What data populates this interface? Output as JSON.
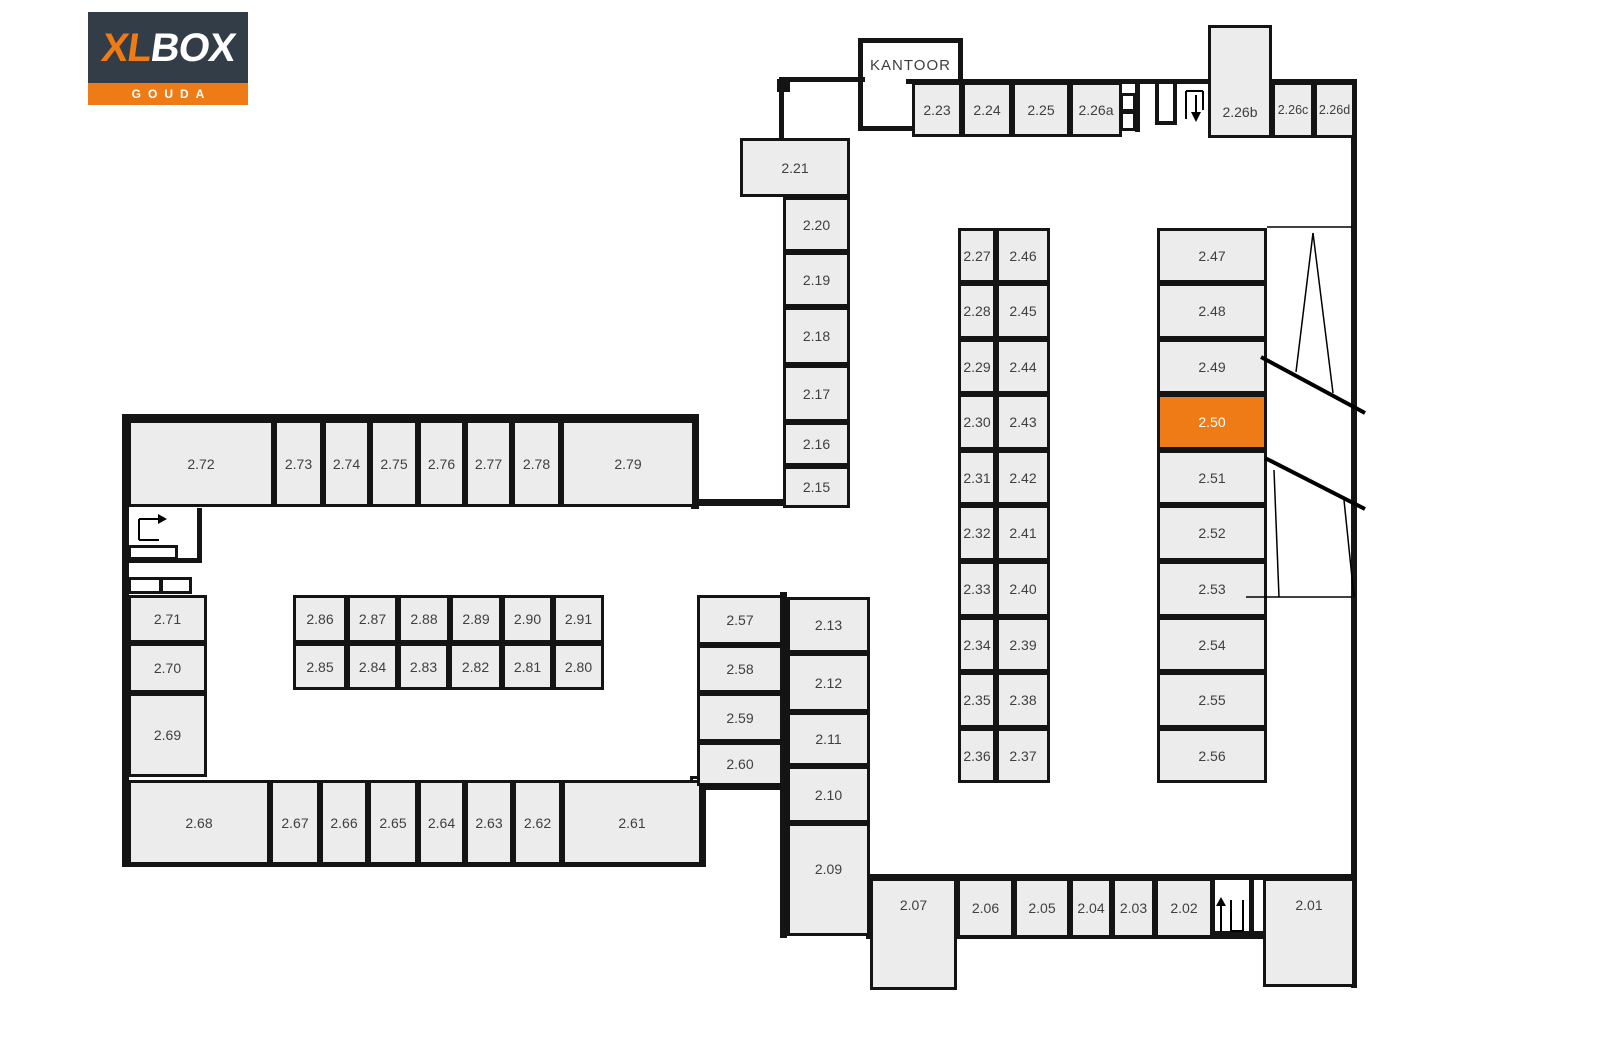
{
  "logo": {
    "brand_xl": "XL",
    "brand_box": "BOX",
    "city": "GOUDA"
  },
  "colors": {
    "navy": "#333D47",
    "orange": "#EE7B16",
    "unit_fill": "#ECECEC",
    "wall": "#141414",
    "label": "#3f3f3f",
    "highlight_label": "#ffffff"
  },
  "office": {
    "label": "KANTOOR",
    "x": 858,
    "y": 38,
    "w": 105,
    "h": 93
  },
  "highlighted_unit": "2.50",
  "units": [
    {
      "id": "2.23",
      "x": 912,
      "y": 82,
      "w": 50,
      "h": 55
    },
    {
      "id": "2.24",
      "x": 962,
      "y": 82,
      "w": 50,
      "h": 55
    },
    {
      "id": "2.25",
      "x": 1012,
      "y": 82,
      "w": 58,
      "h": 55
    },
    {
      "id": "2.26a",
      "x": 1070,
      "y": 82,
      "w": 52,
      "h": 55
    },
    {
      "id": "2.26b",
      "x": 1208,
      "y": 25,
      "w": 64,
      "h": 113,
      "ly": 110
    },
    {
      "id": "2.26c",
      "x": 1272,
      "y": 82,
      "w": 42,
      "h": 56,
      "fs": 12.5
    },
    {
      "id": "2.26d",
      "x": 1314,
      "y": 82,
      "w": 41,
      "h": 56,
      "fs": 12.5
    },
    {
      "id": "2.21",
      "x": 740,
      "y": 138,
      "w": 110,
      "h": 59
    },
    {
      "id": "2.20",
      "x": 783,
      "y": 197,
      "w": 67,
      "h": 55
    },
    {
      "id": "2.19",
      "x": 783,
      "y": 252,
      "w": 67,
      "h": 55
    },
    {
      "id": "2.18",
      "x": 783,
      "y": 307,
      "w": 67,
      "h": 58
    },
    {
      "id": "2.17",
      "x": 783,
      "y": 365,
      "w": 67,
      "h": 57
    },
    {
      "id": "2.16",
      "x": 783,
      "y": 422,
      "w": 67,
      "h": 44
    },
    {
      "id": "2.15",
      "x": 783,
      "y": 466,
      "w": 67,
      "h": 42
    },
    {
      "id": "2.27",
      "x": 958,
      "y": 228,
      "w": 38,
      "h": 55
    },
    {
      "id": "2.28",
      "x": 958,
      "y": 283,
      "w": 38,
      "h": 56
    },
    {
      "id": "2.29",
      "x": 958,
      "y": 339,
      "w": 38,
      "h": 55
    },
    {
      "id": "2.30",
      "x": 958,
      "y": 394,
      "w": 38,
      "h": 56
    },
    {
      "id": "2.31",
      "x": 958,
      "y": 450,
      "w": 38,
      "h": 55
    },
    {
      "id": "2.32",
      "x": 958,
      "y": 505,
      "w": 38,
      "h": 56
    },
    {
      "id": "2.33",
      "x": 958,
      "y": 561,
      "w": 38,
      "h": 56
    },
    {
      "id": "2.34",
      "x": 958,
      "y": 617,
      "w": 38,
      "h": 55
    },
    {
      "id": "2.35",
      "x": 958,
      "y": 672,
      "w": 38,
      "h": 56
    },
    {
      "id": "2.36",
      "x": 958,
      "y": 728,
      "w": 38,
      "h": 55
    },
    {
      "id": "2.46",
      "x": 996,
      "y": 228,
      "w": 54,
      "h": 55
    },
    {
      "id": "2.45",
      "x": 996,
      "y": 283,
      "w": 54,
      "h": 56
    },
    {
      "id": "2.44",
      "x": 996,
      "y": 339,
      "w": 54,
      "h": 55
    },
    {
      "id": "2.43",
      "x": 996,
      "y": 394,
      "w": 54,
      "h": 56
    },
    {
      "id": "2.42",
      "x": 996,
      "y": 450,
      "w": 54,
      "h": 55
    },
    {
      "id": "2.41",
      "x": 996,
      "y": 505,
      "w": 54,
      "h": 56
    },
    {
      "id": "2.40",
      "x": 996,
      "y": 561,
      "w": 54,
      "h": 56
    },
    {
      "id": "2.39",
      "x": 996,
      "y": 617,
      "w": 54,
      "h": 55
    },
    {
      "id": "2.38",
      "x": 996,
      "y": 672,
      "w": 54,
      "h": 56
    },
    {
      "id": "2.37",
      "x": 996,
      "y": 728,
      "w": 54,
      "h": 55
    },
    {
      "id": "2.47",
      "x": 1157,
      "y": 228,
      "w": 110,
      "h": 55
    },
    {
      "id": "2.48",
      "x": 1157,
      "y": 283,
      "w": 110,
      "h": 56
    },
    {
      "id": "2.49",
      "x": 1157,
      "y": 339,
      "w": 110,
      "h": 55
    },
    {
      "id": "2.50",
      "x": 1157,
      "y": 394,
      "w": 110,
      "h": 56,
      "hl": true
    },
    {
      "id": "2.51",
      "x": 1157,
      "y": 450,
      "w": 110,
      "h": 55
    },
    {
      "id": "2.52",
      "x": 1157,
      "y": 505,
      "w": 110,
      "h": 56
    },
    {
      "id": "2.53",
      "x": 1157,
      "y": 561,
      "w": 110,
      "h": 56
    },
    {
      "id": "2.54",
      "x": 1157,
      "y": 617,
      "w": 110,
      "h": 55
    },
    {
      "id": "2.55",
      "x": 1157,
      "y": 672,
      "w": 110,
      "h": 56
    },
    {
      "id": "2.56",
      "x": 1157,
      "y": 728,
      "w": 110,
      "h": 55
    },
    {
      "id": "2.72",
      "x": 128,
      "y": 420,
      "w": 146,
      "h": 87
    },
    {
      "id": "2.73",
      "x": 274,
      "y": 420,
      "w": 49,
      "h": 87
    },
    {
      "id": "2.74",
      "x": 323,
      "y": 420,
      "w": 47,
      "h": 87
    },
    {
      "id": "2.75",
      "x": 370,
      "y": 420,
      "w": 48,
      "h": 87
    },
    {
      "id": "2.76",
      "x": 418,
      "y": 420,
      "w": 47,
      "h": 87
    },
    {
      "id": "2.77",
      "x": 465,
      "y": 420,
      "w": 47,
      "h": 87
    },
    {
      "id": "2.78",
      "x": 512,
      "y": 420,
      "w": 49,
      "h": 87
    },
    {
      "id": "2.79",
      "x": 561,
      "y": 420,
      "w": 134,
      "h": 87
    },
    {
      "id": "2.71",
      "x": 128,
      "y": 595,
      "w": 79,
      "h": 48
    },
    {
      "id": "2.70",
      "x": 128,
      "y": 643,
      "w": 79,
      "h": 50
    },
    {
      "id": "2.69",
      "x": 128,
      "y": 693,
      "w": 79,
      "h": 84
    },
    {
      "id": "2.86",
      "x": 293,
      "y": 595,
      "w": 54,
      "h": 48
    },
    {
      "id": "2.87",
      "x": 347,
      "y": 595,
      "w": 51,
      "h": 48
    },
    {
      "id": "2.88",
      "x": 398,
      "y": 595,
      "w": 52,
      "h": 48
    },
    {
      "id": "2.89",
      "x": 450,
      "y": 595,
      "w": 52,
      "h": 48
    },
    {
      "id": "2.90",
      "x": 502,
      "y": 595,
      "w": 51,
      "h": 48
    },
    {
      "id": "2.91",
      "x": 553,
      "y": 595,
      "w": 51,
      "h": 48
    },
    {
      "id": "2.85",
      "x": 293,
      "y": 643,
      "w": 54,
      "h": 47
    },
    {
      "id": "2.84",
      "x": 347,
      "y": 643,
      "w": 51,
      "h": 47
    },
    {
      "id": "2.83",
      "x": 398,
      "y": 643,
      "w": 51,
      "h": 47
    },
    {
      "id": "2.82",
      "x": 449,
      "y": 643,
      "w": 53,
      "h": 47
    },
    {
      "id": "2.81",
      "x": 502,
      "y": 643,
      "w": 51,
      "h": 47
    },
    {
      "id": "2.80",
      "x": 553,
      "y": 643,
      "w": 51,
      "h": 47
    },
    {
      "id": "2.68",
      "x": 128,
      "y": 780,
      "w": 142,
      "h": 85
    },
    {
      "id": "2.67",
      "x": 270,
      "y": 780,
      "w": 50,
      "h": 85
    },
    {
      "id": "2.66",
      "x": 320,
      "y": 780,
      "w": 48,
      "h": 85
    },
    {
      "id": "2.65",
      "x": 368,
      "y": 780,
      "w": 50,
      "h": 85
    },
    {
      "id": "2.64",
      "x": 418,
      "y": 780,
      "w": 47,
      "h": 85
    },
    {
      "id": "2.63",
      "x": 465,
      "y": 780,
      "w": 48,
      "h": 85
    },
    {
      "id": "2.62",
      "x": 513,
      "y": 780,
      "w": 49,
      "h": 85
    },
    {
      "id": "2.61",
      "x": 562,
      "y": 780,
      "w": 140,
      "h": 85
    },
    {
      "id": "2.57",
      "x": 697,
      "y": 595,
      "w": 86,
      "h": 50
    },
    {
      "id": "2.58",
      "x": 697,
      "y": 645,
      "w": 86,
      "h": 48
    },
    {
      "id": "2.59",
      "x": 697,
      "y": 693,
      "w": 86,
      "h": 49
    },
    {
      "id": "2.60",
      "x": 697,
      "y": 742,
      "w": 86,
      "h": 44
    },
    {
      "id": "2.13",
      "x": 787,
      "y": 597,
      "w": 83,
      "h": 56
    },
    {
      "id": "2.12",
      "x": 787,
      "y": 653,
      "w": 83,
      "h": 59
    },
    {
      "id": "2.11",
      "x": 787,
      "y": 712,
      "w": 83,
      "h": 54
    },
    {
      "id": "2.10",
      "x": 787,
      "y": 766,
      "w": 83,
      "h": 57
    },
    {
      "id": "2.09",
      "x": 787,
      "y": 823,
      "w": 83,
      "h": 113,
      "ly": 867
    },
    {
      "id": "2.07",
      "x": 870,
      "y": 878,
      "w": 87,
      "h": 112,
      "ly": 903
    },
    {
      "id": "2.06",
      "x": 957,
      "y": 878,
      "w": 57,
      "h": 60
    },
    {
      "id": "2.05",
      "x": 1014,
      "y": 878,
      "w": 56,
      "h": 60
    },
    {
      "id": "2.04",
      "x": 1070,
      "y": 878,
      "w": 42,
      "h": 60
    },
    {
      "id": "2.03",
      "x": 1112,
      "y": 878,
      "w": 43,
      "h": 60
    },
    {
      "id": "2.02",
      "x": 1155,
      "y": 878,
      "w": 58,
      "h": 60
    },
    {
      "id": "2.01",
      "x": 1263,
      "y": 878,
      "w": 92,
      "h": 109,
      "ly": 903
    }
  ],
  "walls": [
    [
      781,
      77,
      84,
      5
    ],
    [
      779,
      77,
      5,
      63
    ],
    [
      906,
      79,
      304,
      5
    ],
    [
      1272,
      79,
      84,
      5
    ],
    [
      1351,
      79,
      6,
      909
    ],
    [
      1135,
      82,
      5,
      50
    ],
    [
      1155,
      82,
      4,
      43
    ],
    [
      1173,
      82,
      4,
      43
    ],
    [
      1155,
      121,
      22,
      4
    ],
    [
      693,
      499,
      92,
      7
    ],
    [
      122,
      414,
      577,
      7
    ],
    [
      122,
      414,
      7,
      453
    ],
    [
      122,
      859,
      584,
      8
    ],
    [
      691,
      414,
      8,
      95
    ],
    [
      699,
      779,
      7,
      88
    ],
    [
      197,
      508,
      5,
      54
    ],
    [
      128,
      558,
      74,
      5
    ],
    [
      695,
      784,
      90,
      6
    ],
    [
      780,
      592,
      7,
      346
    ],
    [
      866,
      874,
      489,
      6
    ],
    [
      866,
      931,
      489,
      8
    ],
    [
      1210,
      874,
      5,
      62
    ],
    [
      1249,
      874,
      5,
      62
    ]
  ],
  "black_markers": [
    [
      777,
      79,
      13,
      13
    ]
  ],
  "white_markers": [
    [
      690,
      776,
      12,
      12
    ]
  ],
  "white_boxes": [
    [
      1120,
      93,
      16,
      19
    ],
    [
      1120,
      111,
      16,
      20
    ],
    [
      128,
      545,
      50,
      15
    ],
    [
      128,
      577,
      34,
      17
    ],
    [
      160,
      577,
      32,
      17
    ]
  ],
  "icons": [
    {
      "name": "stairs-down-icon",
      "sw": 2,
      "lines": [
        [
          1186,
          119,
          1186,
          91
        ],
        [
          1186,
          91,
          1203,
          91
        ],
        [
          1203,
          91,
          1203,
          110
        ],
        [
          1196,
          95,
          1196,
          113
        ]
      ],
      "polys": [
        "1191,112 1201,112 1196,122"
      ]
    },
    {
      "name": "stairs-up-icon",
      "sw": 2,
      "lines": [
        [
          1221,
          932,
          1221,
          905
        ],
        [
          1231,
          900,
          1231,
          931
        ],
        [
          1231,
          931,
          1243,
          931
        ],
        [
          1243,
          931,
          1243,
          900
        ]
      ],
      "polys": [
        "1216,906 1226,906 1221,897"
      ]
    },
    {
      "name": "stairs-right-icon",
      "sw": 2,
      "lines": [
        [
          139,
          540,
          139,
          519
        ],
        [
          139,
          519,
          159,
          519
        ],
        [
          139,
          540,
          159,
          540
        ]
      ],
      "polys": [
        "158,514 158,524 167,519"
      ]
    },
    {
      "name": "ramp-lines-thin",
      "sw": 1.5,
      "lines": [
        [
          1267,
          227,
          1352,
          227
        ],
        [
          1246,
          597,
          1352,
          597
        ],
        [
          1313,
          233,
          1296,
          372
        ],
        [
          1313,
          233,
          1333,
          393
        ],
        [
          1274,
          470,
          1279,
          597
        ],
        [
          1344,
          500,
          1354,
          597
        ]
      ],
      "polys": []
    },
    {
      "name": "ramp-lines-thick",
      "sw": 4,
      "lines": [
        [
          1261,
          357,
          1365,
          413
        ],
        [
          1265,
          458,
          1365,
          509
        ]
      ],
      "polys": []
    }
  ]
}
